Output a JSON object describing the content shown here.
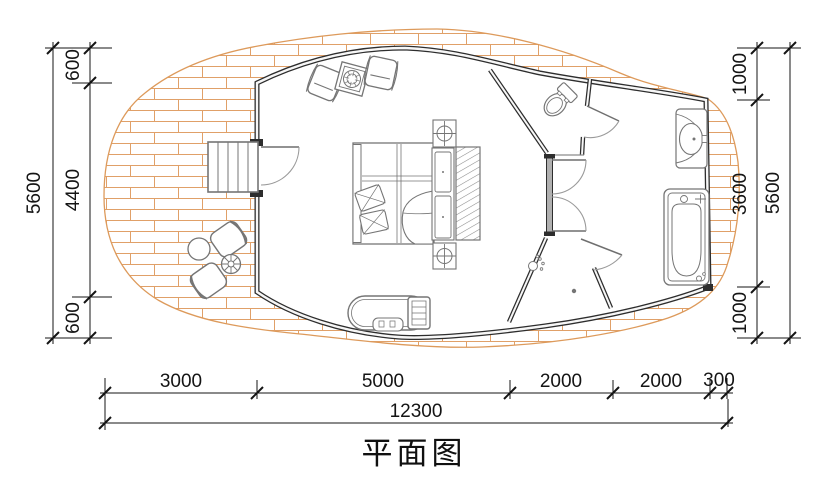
{
  "title": "平面图",
  "drawing": {
    "type": "architectural-floor-plan",
    "rooms": [
      "terrace",
      "bedroom",
      "toilet-room",
      "vestibule",
      "shower-room",
      "bath-area"
    ],
    "furniture_icons": [
      "stairs-icon",
      "entry-door-icon",
      "door-swing-icon",
      "outdoor-chair-icon",
      "outdoor-round-table-icon",
      "parasol-table-icon",
      "armchair-icon",
      "side-table-icon",
      "plant-icon",
      "double-bed-icon",
      "pillow-icon",
      "duvet-icon",
      "nightstand-icon",
      "ceiling-lamp-icon",
      "wardrobe-icon",
      "tv-cabinet-icon",
      "tv-icon",
      "remote-icon",
      "toilet-icon",
      "washbasin-icon",
      "bathtub-icon",
      "shower-head-icon",
      "floor-drain-icon"
    ]
  },
  "dimensions": {
    "left": {
      "total": "5600",
      "segments": [
        "600",
        "4400",
        "600"
      ]
    },
    "right": {
      "total": "5600",
      "segments": [
        "1000",
        "3600",
        "1000"
      ]
    },
    "bottom": {
      "segments": [
        "3000",
        "5000",
        "2000",
        "2000",
        "300"
      ],
      "total": "12300"
    }
  },
  "colors": {
    "background": "#ffffff",
    "brick_line": "#e0a068",
    "wall_line": "#2d2d2d",
    "furniture_line": "#757575",
    "dimension_line": "#141414"
  }
}
